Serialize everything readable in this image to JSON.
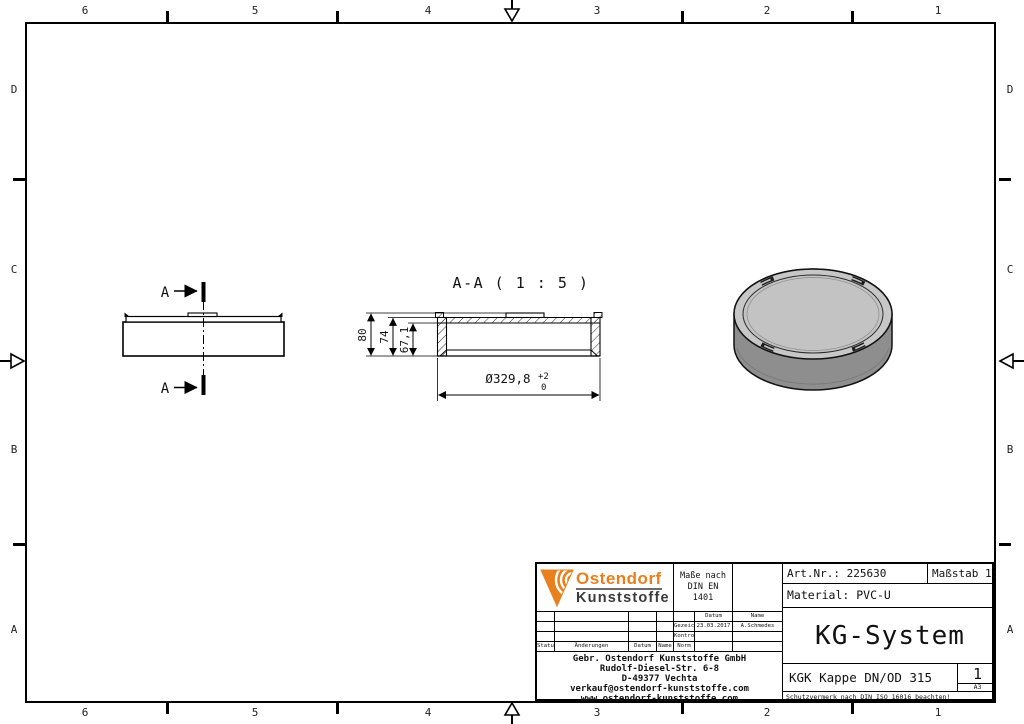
{
  "border_refs": {
    "top": [
      "6",
      "5",
      "4",
      "3",
      "2",
      "1"
    ],
    "bottom": [
      "6",
      "5",
      "4",
      "3",
      "2",
      "1"
    ],
    "left": [
      "D",
      "C",
      "B",
      "A"
    ],
    "right": [
      "D",
      "C",
      "B",
      "A"
    ]
  },
  "drawing": {
    "front_view": {
      "section_label": "A"
    },
    "section_view": {
      "title": "A-A ( 1 : 5 )",
      "dim_total_height": "80",
      "dim_mid_height": "74",
      "dim_inner_height": "67,1",
      "dim_diameter": "Ø329,8",
      "dim_tol_upper": "+2",
      "dim_tol_lower": "0"
    },
    "iso_view": {
      "top_color": "#c7c7c7",
      "side_color": "#8e8e8e"
    }
  },
  "titleblock": {
    "logo": {
      "brand": "Ostendorf",
      "sub": "Kunststoffe",
      "orange": "#e8801e"
    },
    "standard": {
      "line1": "Maße nach",
      "line2": "DIN EN",
      "line3": "1401"
    },
    "art_nr": "Art.Nr.: 225630",
    "massstab": "Maßstab 1:5",
    "material": "Material: PVC-U",
    "system": "KG-System",
    "revision": {
      "col_datum": "Datum",
      "col_name": "Name",
      "rows": [
        {
          "label": "Gezeichn.",
          "datum": "23.03.2017",
          "name": "A.Schmedes"
        },
        {
          "label": "Kontroll.",
          "datum": "",
          "name": ""
        },
        {
          "label": "Norm",
          "datum": "",
          "name": ""
        }
      ],
      "footer": {
        "status": "Status",
        "aenderungen": "Änderungen",
        "datum": "Datum",
        "name": "Name"
      }
    },
    "address": {
      "line1": "Gebr. Ostendorf Kunststoffe GmbH",
      "line2": "Rudolf-Diesel-Str. 6-8",
      "line3": "D-49377 Vechta",
      "line4": "verkauf@ostendorf-kunststoffe.com",
      "line5": "www.ostendorf-kunststoffe.com"
    },
    "part": "KGK Kappe DN/OD 315",
    "sheet": "1",
    "format": "A3",
    "schutzvermerk": "Schutzvermerk nach DIN ISO 16016 beachten!"
  }
}
